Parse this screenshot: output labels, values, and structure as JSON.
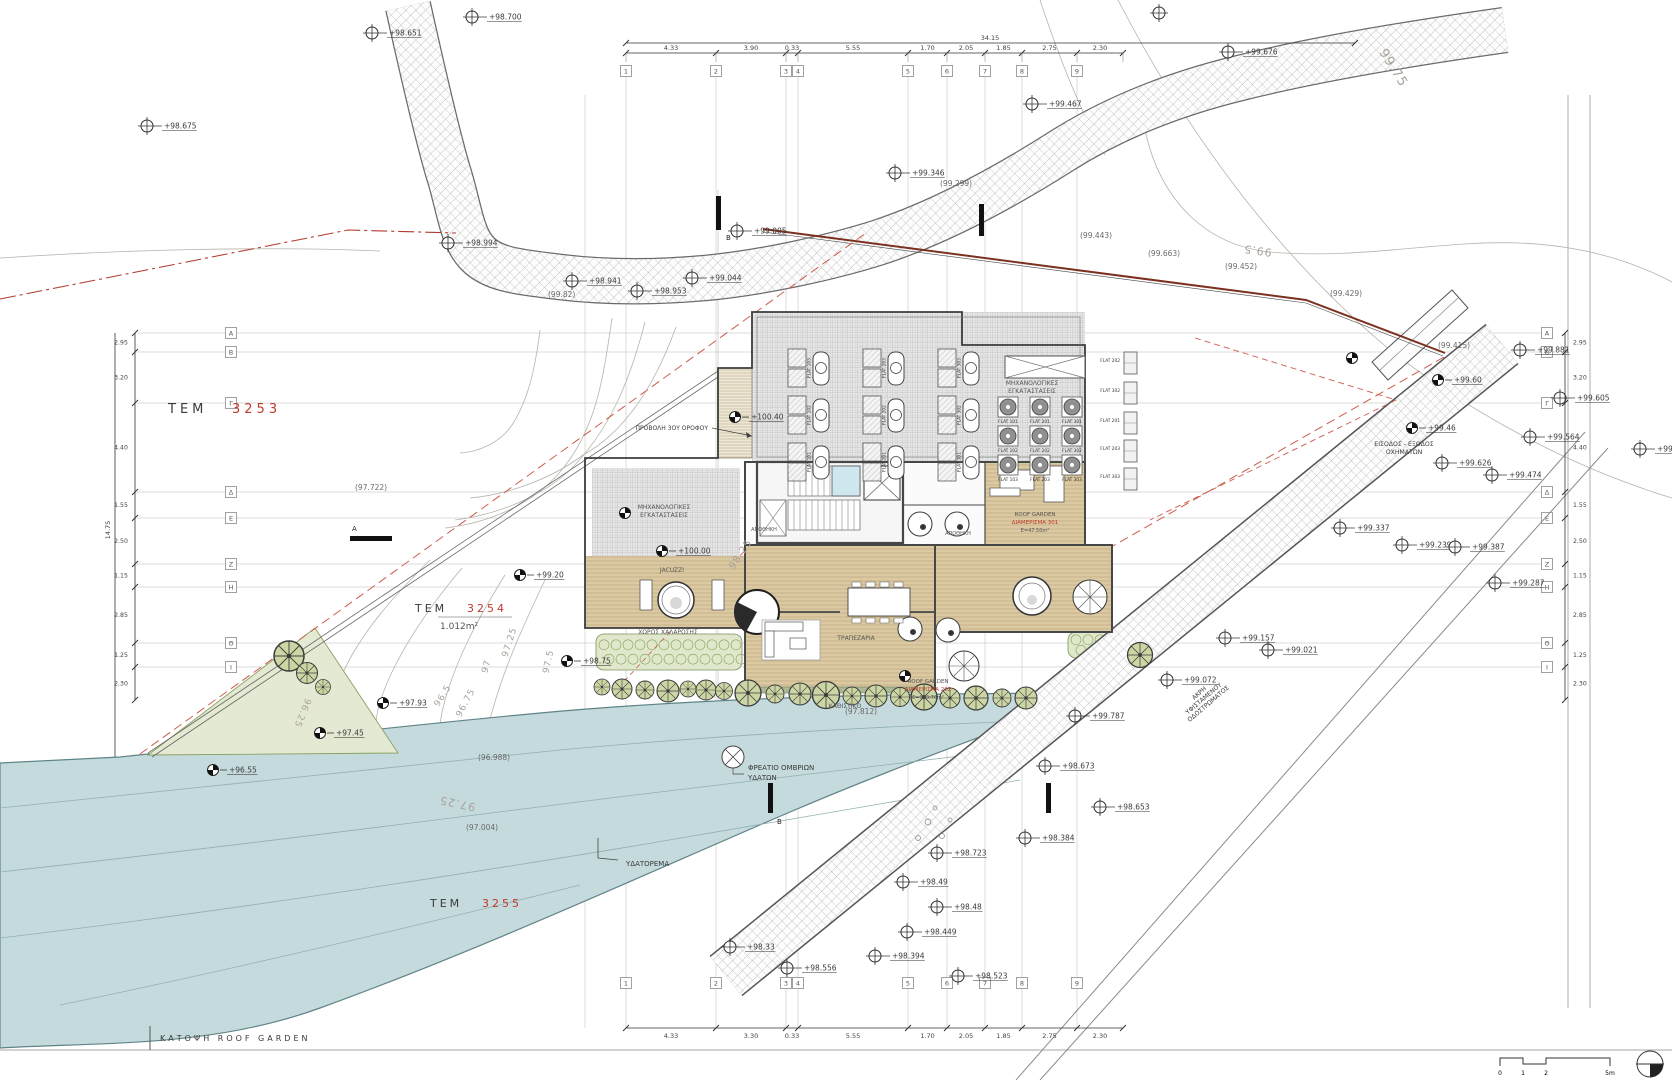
{
  "drawing": {
    "title": "ΚΑΤΟΨΗ ROOF GARDEN"
  },
  "plots": {
    "tem3253": {
      "prefix": "ΤΕΜ",
      "number": "3253"
    },
    "tem3254": {
      "prefix": "ΤΕΜ",
      "number": "3254",
      "area": "1.012m²"
    },
    "tem3255": {
      "prefix": "ΤΕΜ",
      "number": "3255"
    }
  },
  "colors": {
    "plot_number": "#c0392b",
    "red_dashed": "#cd5c4e",
    "boundary": "#7c3020",
    "water": "#c5dadc",
    "green": "#e3e9d2"
  },
  "rooms": {
    "mech_left_1": "ΜΗΧΑΝΟΛΟΓΙΚΕΣ",
    "mech_left_2": "ΕΓΚΑΤΑΣΤΑΣΕΙΣ",
    "mech_roof_1": "ΜΗΧΑΝΟΛΟΓΙΚΕΣ",
    "mech_roof_2": "ΕΓΚΑΤΑΣΤΑΣΕΙΣ",
    "jacuzzi": "JACUZZI",
    "relax": "ΧΩΡΟΣ ΧΑΛΑΡΩΣΗΣ",
    "dining": "ΤΡΑΠΕΖΑΡΙΑ",
    "sitting": "ΚΑΘΙΣΤΙΚΟ",
    "storage1": "ΑΠΟΘΗΚΗ",
    "storage2": "ΑΠΟΘΗΚΗ",
    "rg301_1": "ROOF GARDEN",
    "rg301_2": "ΔΙΑΜΕΡΙΣΜΑ 301",
    "rg301_3": "Ε=47.50m²",
    "rg202_1": "ROOF GARDEN",
    "rg202_2": "ΔΙΑΜΕΡΙΣΜΑ 202",
    "rg202_3": "Ε=113.70m²"
  },
  "labels": {
    "watercourse": "ΥΔΑΤΟΡΕΜΑ",
    "storm_1": "ΦΡΕΑΤΙΟ ΟΜΒΡΙΩΝ",
    "storm_2": "ΥΔΑΤΩΝ",
    "access_1": "ΕΙΣΟΔΟΣ - ΕΞΟΔΟΣ",
    "access_2": "ΟΧΗΜΑΤΩΝ",
    "roadedge_1": "ΑΚΡΗ",
    "roadedge_2": "ΥΦΙΣΤΑΜΕΝΟΥ",
    "roadedge_3": "ΟΔΟΣΤΡΩΜΑΤΟΣ",
    "projection": "ΠΡΟΒΟΛΗ 3ΟΥ ΟΡΟΦΟΥ",
    "section_a": "Α",
    "section_b": "Β"
  },
  "contour_labels": [
    {
      "t": "99.75",
      "x": 1390,
      "y": 70,
      "r": 58,
      "s": 13
    },
    {
      "t": "99.5",
      "x": 1258,
      "y": 247,
      "r": 188,
      "s": 11
    },
    {
      "t": "98.25",
      "x": 743,
      "y": 556,
      "r": -56,
      "s": 10
    },
    {
      "t": "97.5",
      "x": 551,
      "y": 662,
      "r": -78,
      "s": 9
    },
    {
      "t": "97.25",
      "x": 512,
      "y": 643,
      "r": -72,
      "s": 9
    },
    {
      "t": "97",
      "x": 489,
      "y": 667,
      "r": -75,
      "s": 9
    },
    {
      "t": "96.75",
      "x": 468,
      "y": 704,
      "r": -62,
      "s": 9
    },
    {
      "t": "96.5",
      "x": 445,
      "y": 697,
      "r": -58,
      "s": 9
    },
    {
      "t": "96.25",
      "x": 300,
      "y": 712,
      "r": 112,
      "s": 9
    },
    {
      "t": "97.25",
      "x": 458,
      "y": 800,
      "r": 192,
      "s": 11
    }
  ],
  "markers": [
    [
      472,
      17,
      "cc",
      "+98.700"
    ],
    [
      372,
      33,
      "cc",
      "+98.651"
    ],
    [
      147,
      126,
      "cc",
      "+98.675"
    ],
    [
      448,
      243,
      "cc",
      "+98.994"
    ],
    [
      572,
      281,
      "cc",
      "+98.941"
    ],
    [
      548,
      297,
      "tx",
      "(99.82)"
    ],
    [
      637,
      291,
      "cc",
      "+98.953"
    ],
    [
      692,
      278,
      "cc",
      "+99.044"
    ],
    [
      737,
      231,
      "cc",
      "+99.005"
    ],
    [
      895,
      173,
      "cc",
      "+99.346"
    ],
    [
      940,
      186,
      "tx",
      "(99.299)"
    ],
    [
      1032,
      104,
      "cc",
      "+99.467"
    ],
    [
      1159,
      13,
      "cc",
      ""
    ],
    [
      1228,
      52,
      "cc",
      "+99.676"
    ],
    [
      1080,
      238,
      "tx",
      "(99.443)"
    ],
    [
      1148,
      256,
      "tx",
      "(99.663)"
    ],
    [
      1225,
      269,
      "tx",
      "(99.452)"
    ],
    [
      1330,
      296,
      "tx",
      "(99.429)"
    ],
    [
      1438,
      348,
      "tx",
      "(99.415)"
    ],
    [
      1520,
      350,
      "cc",
      "+99.881"
    ],
    [
      1560,
      398,
      "cc",
      "+99.605"
    ],
    [
      1530,
      437,
      "cc",
      "+99.564"
    ],
    [
      1640,
      449,
      "cc",
      "+99.52"
    ],
    [
      1492,
      475,
      "cc",
      "+99.474"
    ],
    [
      1442,
      463,
      "cc",
      "+99.626"
    ],
    [
      1340,
      528,
      "cc",
      "+99.337"
    ],
    [
      1402,
      545,
      "cc",
      "+99.239"
    ],
    [
      1455,
      547,
      "cc",
      "+99.387"
    ],
    [
      1495,
      583,
      "cc",
      "+99.287"
    ],
    [
      1268,
      650,
      "cc",
      "+99.021"
    ],
    [
      1225,
      638,
      "cc",
      "+99.157"
    ],
    [
      1167,
      680,
      "cc",
      "+99.072"
    ],
    [
      1075,
      716,
      "cc",
      "+99.787"
    ],
    [
      1045,
      766,
      "cc",
      "+98.673"
    ],
    [
      1100,
      807,
      "cc",
      "+98.653"
    ],
    [
      1025,
      838,
      "cc",
      "+98.384"
    ],
    [
      937,
      853,
      "cc",
      "+98.723"
    ],
    [
      903,
      882,
      "cc",
      "+98.49"
    ],
    [
      937,
      907,
      "cc",
      "+98.48"
    ],
    [
      907,
      932,
      "cc",
      "+98.449"
    ],
    [
      875,
      956,
      "cc",
      "+98.394"
    ],
    [
      787,
      968,
      "cc",
      "+98.556"
    ],
    [
      958,
      976,
      "cc",
      "+98.523"
    ],
    [
      730,
      947,
      "cc",
      "+98.33"
    ],
    [
      355,
      490,
      "tx",
      "(97.722)"
    ],
    [
      845,
      714,
      "tx",
      "(97.812)"
    ],
    [
      478,
      760,
      "tx",
      "(96.988)"
    ],
    [
      466,
      830,
      "tx",
      "(97.004)"
    ],
    [
      383,
      703,
      "sv",
      "+97.93"
    ],
    [
      320,
      733,
      "sv",
      "+97.45"
    ],
    [
      213,
      770,
      "sv",
      "+96.55"
    ],
    [
      735,
      417,
      "sv",
      "+100.40"
    ],
    [
      662,
      551,
      "sv",
      "+100.00"
    ],
    [
      905,
      676,
      "sv",
      ""
    ],
    [
      1438,
      380,
      "sv",
      "+99.60"
    ],
    [
      1412,
      428,
      "sv",
      "+99.46"
    ],
    [
      520,
      575,
      "sv",
      "+99.20"
    ],
    [
      567,
      661,
      "sv",
      "+98.75"
    ],
    [
      1352,
      358,
      "sv",
      ""
    ],
    [
      625,
      513,
      "sv",
      ""
    ]
  ],
  "grid": {
    "cols": [
      {
        "l": "1",
        "x": 626
      },
      {
        "l": "2",
        "x": 716
      },
      {
        "l": "3",
        "x": 786
      },
      {
        "l": "4",
        "x": 798
      },
      {
        "l": "5",
        "x": 908
      },
      {
        "l": "6",
        "x": 947
      },
      {
        "l": "7",
        "x": 985
      },
      {
        "l": "8",
        "x": 1022
      },
      {
        "l": "9",
        "x": 1077
      }
    ],
    "rows": [
      {
        "l": "Α",
        "y": 333
      },
      {
        "l": "Β",
        "y": 352
      },
      {
        "l": "Γ",
        "y": 403
      },
      {
        "l": "Δ",
        "y": 492
      },
      {
        "l": "Ε",
        "y": 518
      },
      {
        "l": "Ζ",
        "y": 564
      },
      {
        "l": "Η",
        "y": 587
      },
      {
        "l": "Θ",
        "y": 643
      },
      {
        "l": "Ι",
        "y": 667
      }
    ]
  },
  "dims": {
    "top": {
      "ticks": [
        626,
        716,
        786,
        798,
        908,
        947,
        985,
        1022,
        1077,
        1123
      ],
      "values": [
        "4.33",
        "3.90",
        "0.33",
        "5.55",
        "1.70",
        "2.05",
        "1.85",
        "2.75",
        "2.30"
      ],
      "total": "34.15"
    },
    "bottom": {
      "ticks": [
        626,
        716,
        786,
        798,
        908,
        947,
        985,
        1022,
        1077,
        1123
      ],
      "values": [
        "4.33",
        "3.30",
        "0.33",
        "5.55",
        "1.70",
        "2.05",
        "1.85",
        "2.75",
        "2.30"
      ]
    },
    "left": {
      "ticks": [
        333,
        352,
        403,
        492,
        518,
        564,
        587,
        643,
        667,
        700
      ],
      "values": [
        "2.95",
        "3.20",
        "4.40",
        "1.55",
        "2.50",
        "1.15",
        "2.85",
        "1.25",
        "2.30"
      ],
      "total": "14.75"
    },
    "right": {
      "ticks": [
        333,
        352,
        403,
        492,
        518,
        564,
        587,
        643,
        667,
        700
      ],
      "values": [
        "2.95",
        "3.20",
        "4.40",
        "1.55",
        "2.50",
        "1.15",
        "2.85",
        "1.25",
        "2.30"
      ]
    }
  },
  "equipment": {
    "solar": [
      "FLAT 103",
      "FLAT 203",
      "FLAT 303",
      "FLAT 102",
      "FLAT 202",
      "FLAT 302",
      "FLAT 101",
      "FLAT 201",
      "FLAT 301"
    ],
    "ac": [
      "FLAT 101",
      "FLAT 201",
      "FLAT 301",
      "FLAT 102",
      "FLAT 202",
      "FLAT 302",
      "FLAT 103",
      "FLAT 203",
      "FLAT 303"
    ],
    "stack": [
      "FLAT 202",
      "FLAT 302",
      "FLAT 201",
      "FLAT 203",
      "FLAT 303"
    ]
  },
  "scalebar": {
    "t0": "0",
    "t1": "1",
    "t2": "2",
    "t5": "5m"
  }
}
